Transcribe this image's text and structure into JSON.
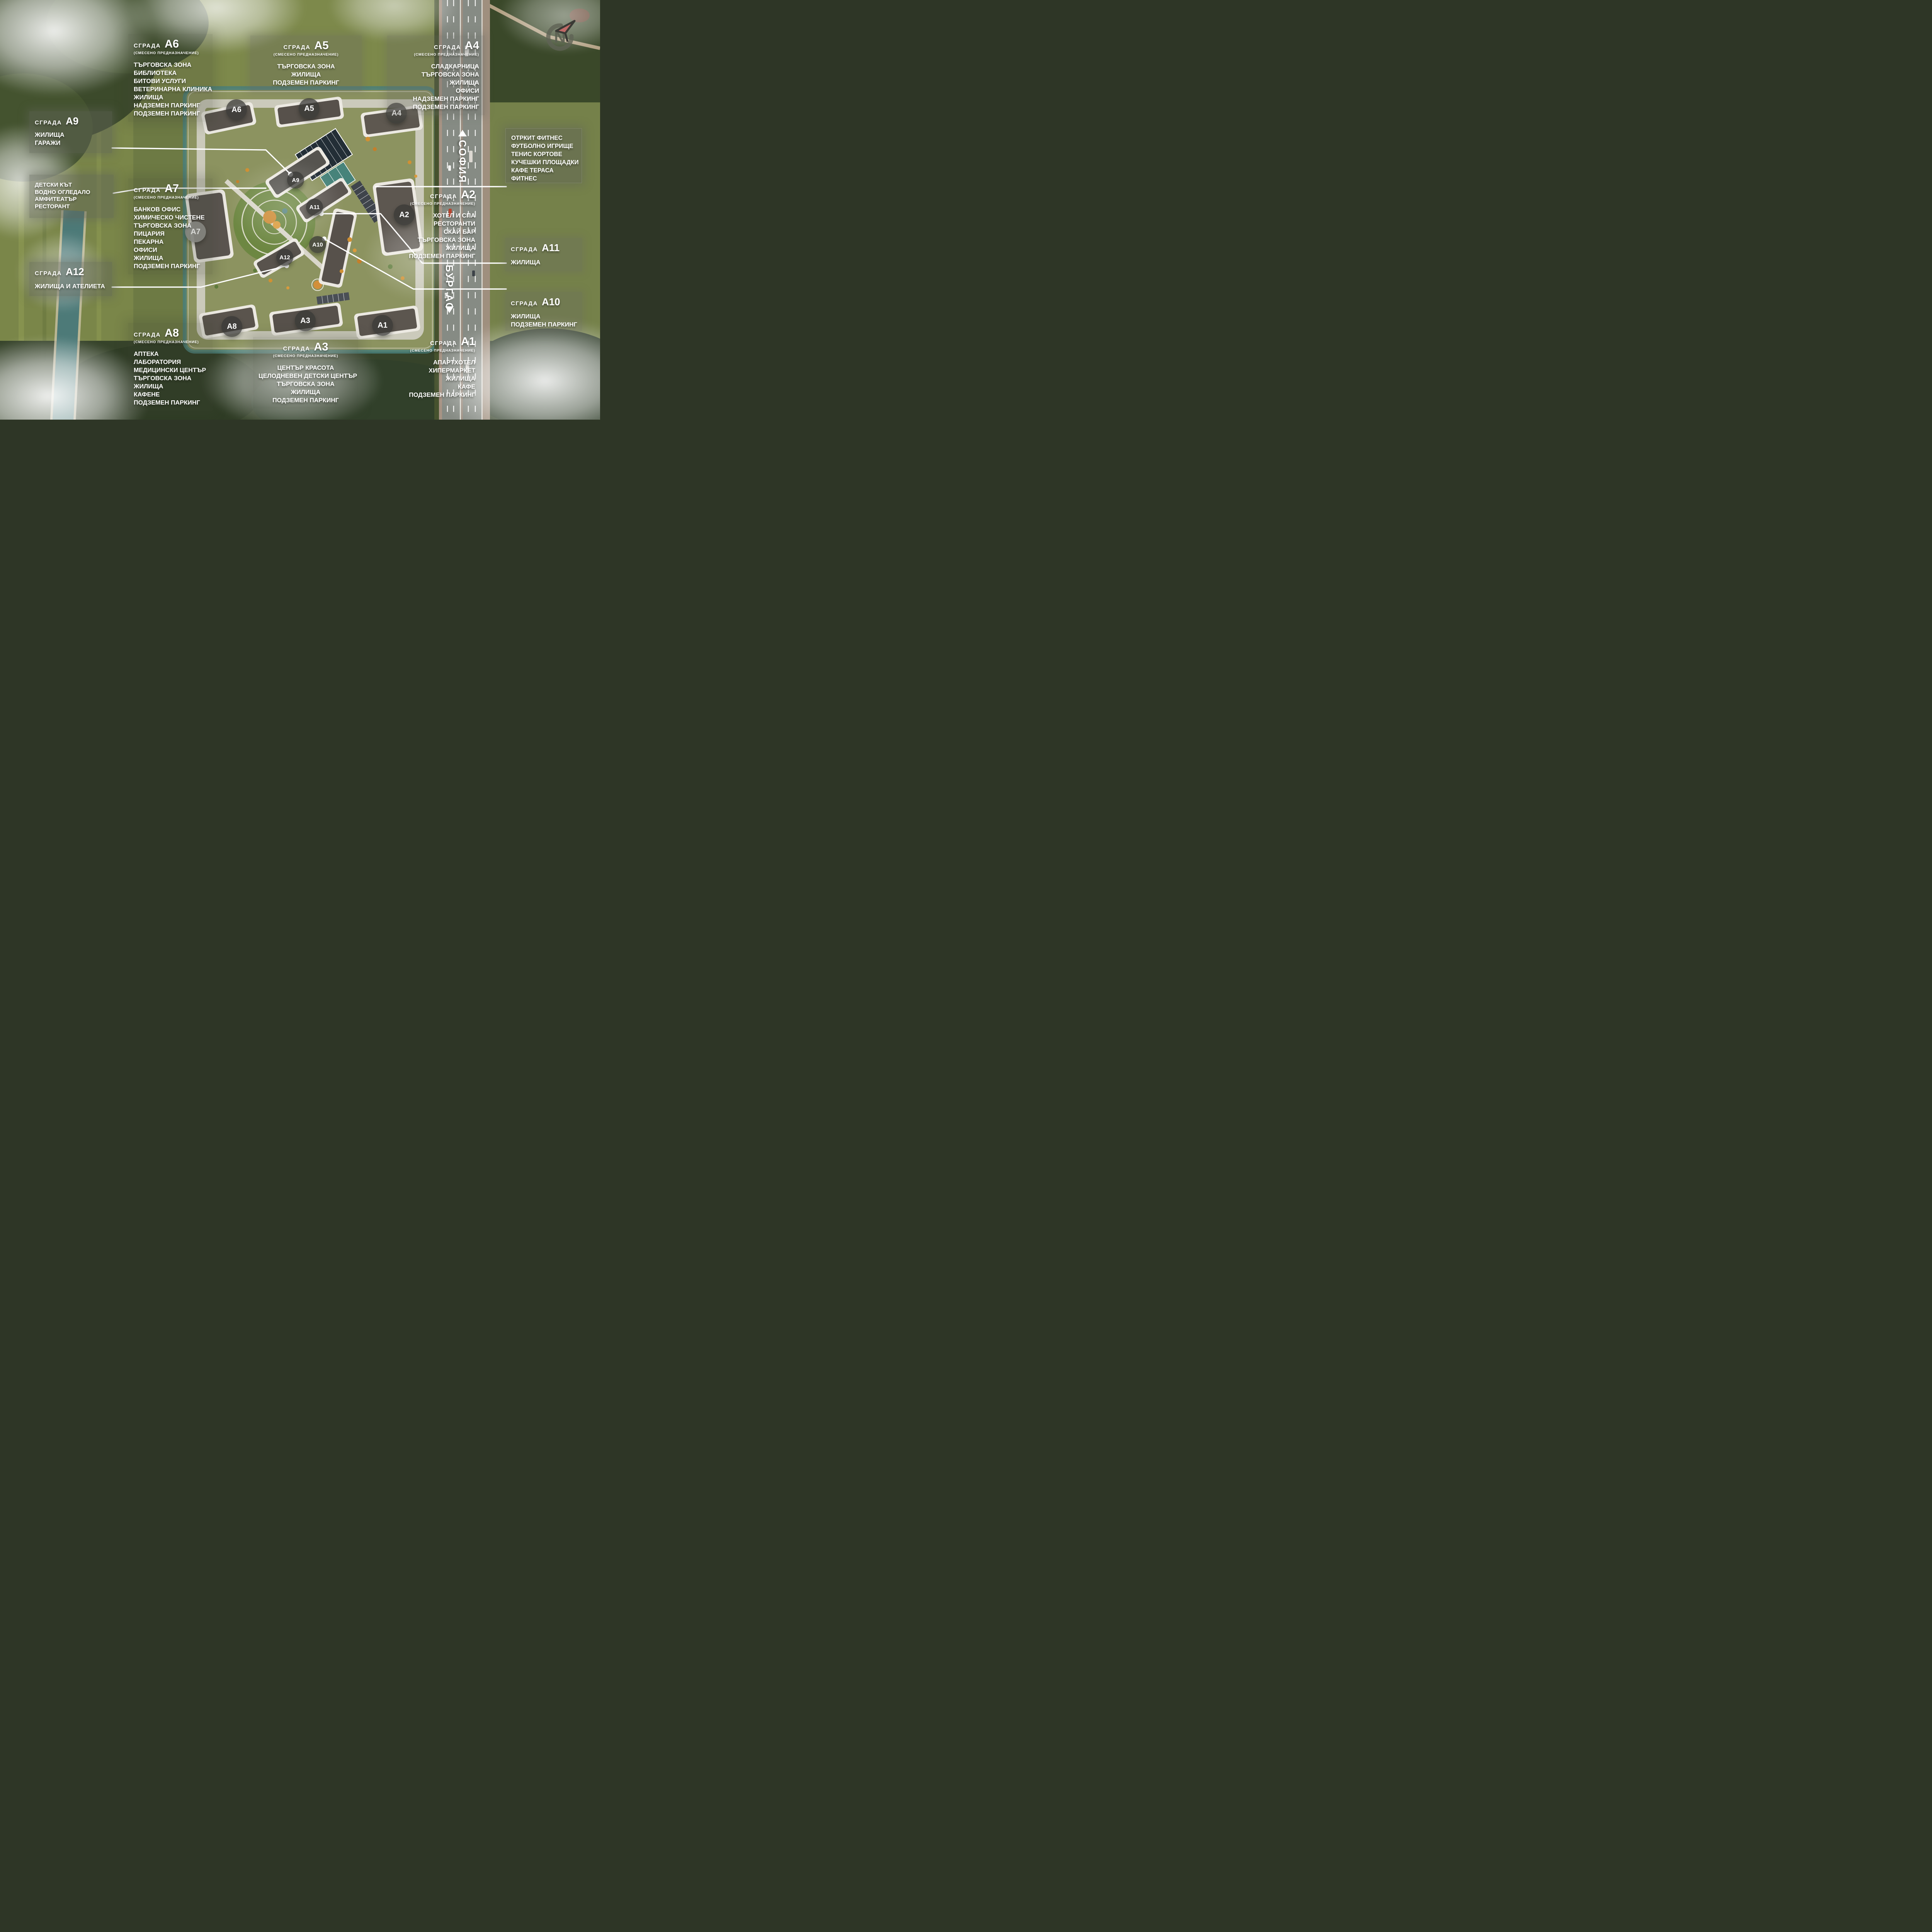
{
  "compass": {
    "letter": "N"
  },
  "road_labels": {
    "north": "СОФИЯ",
    "south": "БУРГАС"
  },
  "colors": {
    "field_green": "#7a8649",
    "forest_green": "#3c4a2b",
    "site_canal": "#4a7f79",
    "asphalt": "#868b84",
    "panel_gray": "rgba(97,100,88,0.48)",
    "roof_dark": "#57514b",
    "tree_orange": "#d09033",
    "accent_red": "#c06a67",
    "pitch_dark": "#232e36",
    "tennis_teal": "#47837a",
    "text_white": "#ffffff"
  },
  "markers": {
    "a1": {
      "code": "А1"
    },
    "a2": {
      "code": "А2"
    },
    "a3": {
      "code": "А3"
    },
    "a4": {
      "code": "А4"
    },
    "a5": {
      "code": "А5"
    },
    "a6": {
      "code": "А6"
    },
    "a7": {
      "code": "А7"
    },
    "a8": {
      "code": "А8"
    },
    "a9": {
      "code": "А9"
    },
    "a10": {
      "code": "А10"
    },
    "a11": {
      "code": "А11"
    },
    "a12": {
      "code": "А12"
    }
  },
  "boxes": {
    "a6": {
      "label": "СГРАДА",
      "code": "А6",
      "subtitle": "(СМЕСЕНО ПРЕДНАЗНАЧЕНИЕ)",
      "lines": [
        "ТЪРГОВСКА ЗОНА",
        "БИБЛИОТЕКА",
        "БИТОВИ УСЛУГИ",
        "ВЕТЕРИНАРНА КЛИНИКА",
        "ЖИЛИЩА",
        "НАДЗЕМЕН ПАРКИНГ",
        "ПОДЗЕМЕН ПАРКИНГ"
      ]
    },
    "a5": {
      "label": "СГРАДА",
      "code": "А5",
      "subtitle": "(СМЕСЕНО ПРЕДНАЗНАЧЕНИЕ)",
      "lines": [
        "ТЪРГОВСКА ЗОНА",
        "ЖИЛИЩА",
        "ПОДЗЕМЕН ПАРКИНГ"
      ]
    },
    "a4": {
      "label": "СГРАДА",
      "code": "А4",
      "subtitle": "(СМЕСЕНО ПРЕДНАЗНАЧЕНИЕ)",
      "lines": [
        "СЛАДКАРНИЦА",
        "ТЪРГОВСКА ЗОНА",
        "ЖИЛИЩА",
        "ОФИСИ",
        "НАДЗЕМЕН ПАРКИНГ",
        "ПОДЗЕМЕН ПАРКИНГ"
      ]
    },
    "a9": {
      "label": "СГРАДА",
      "code": "А9",
      "subtitle": "",
      "lines": [
        "ЖИЛИЩА",
        "ГАРАЖИ"
      ]
    },
    "detski": {
      "lines": [
        "ДЕТСКИ КЪТ",
        "ВОДНО ОГЛЕДАЛО",
        "АМФИТЕАТЪР",
        "РЕСТОРАНТ"
      ]
    },
    "a7": {
      "label": "СГРАДА",
      "code": "А7",
      "subtitle": "(СМЕСЕНО ПРЕДНАЗНАЧЕНИЕ)",
      "lines": [
        "БАНКОВ ОФИС",
        "ХИМИЧЕСКО ЧИСТЕНЕ",
        "ТЪРГОВСКА ЗОНА",
        "ПИЦАРИЯ",
        "ПЕКАРНА",
        "ОФИСИ",
        "ЖИЛИЩА",
        "ПОДЗЕМЕН ПАРКИНГ"
      ]
    },
    "a12": {
      "label": "СГРАДА",
      "code": "А12",
      "subtitle": "",
      "lines": [
        "ЖИЛИЩА И АТЕЛИЕТА"
      ]
    },
    "otkrit": {
      "lines": [
        "ОТРКИТ ФИТНЕС",
        "ФУТБОЛНО ИГРИЩЕ",
        "ТЕНИС КОРТОВЕ",
        "КУЧЕШКИ ПЛОЩАДКИ",
        "КАФЕ ТЕРАСА",
        "ФИТНЕС"
      ]
    },
    "a2": {
      "label": "СГРАДА",
      "code": "А2",
      "subtitle": "(СМЕСЕНО ПРЕДНАЗНАЧЕНИЕ)",
      "lines": [
        "ХОТЕЛ И СПА",
        "РЕСТОРАНТИ",
        "СКАЙ БАР",
        "ТЪРГОВСКА ЗОНА",
        "ЖИЛИЩА",
        "ПОДЗЕМЕН ПАРКИНГ"
      ]
    },
    "a11": {
      "label": "СГРАДА",
      "code": "А11",
      "subtitle": "",
      "lines": [
        "ЖИЛИЩА"
      ]
    },
    "a10": {
      "label": "СГРАДА",
      "code": "А10",
      "subtitle": "",
      "lines": [
        "ЖИЛИЩА",
        "ПОДЗЕМЕН ПАРКИНГ"
      ]
    },
    "a1": {
      "label": "СГРАДА",
      "code": "А1",
      "subtitle": "(СМЕСЕНО ПРЕДНАЗНАЧЕНИЕ)",
      "lines": [
        "АПАРТХОТЕЛ",
        "ХИПЕРМАРКЕТ",
        "ЖИЛИЩА",
        "КАФЕ",
        "ПОДЗЕМЕН ПАРКИНГ"
      ]
    },
    "a3": {
      "label": "СГРАДА",
      "code": "А3",
      "subtitle": "(СМЕСЕНО ПРЕДНАЗНАЧЕНИЕ)",
      "lines": [
        "ЦЕНТЪР КРАСОТА",
        "ЦЕЛОДНЕВЕН ДЕТСКИ ЦЕНТЪР",
        "ТЪРГОВСКА ЗОНА",
        "ЖИЛИЩА",
        "ПОДЗЕМЕН ПАРКИНГ"
      ]
    },
    "a8": {
      "label": "СГРАДА",
      "code": "А8",
      "subtitle": "(СМЕСЕНО ПРЕДНАЗНАЧЕНИЕ)",
      "lines": [
        "АПТЕКА",
        "ЛАБОРАТОРИЯ",
        "МЕДИЦИНСКИ ЦЕНТЪР",
        "ТЪРГОВСКА ЗОНА",
        "ЖИЛИЩА",
        "КАФЕНЕ",
        "ПОДЗЕМЕН ПАРКИНГ"
      ]
    }
  }
}
